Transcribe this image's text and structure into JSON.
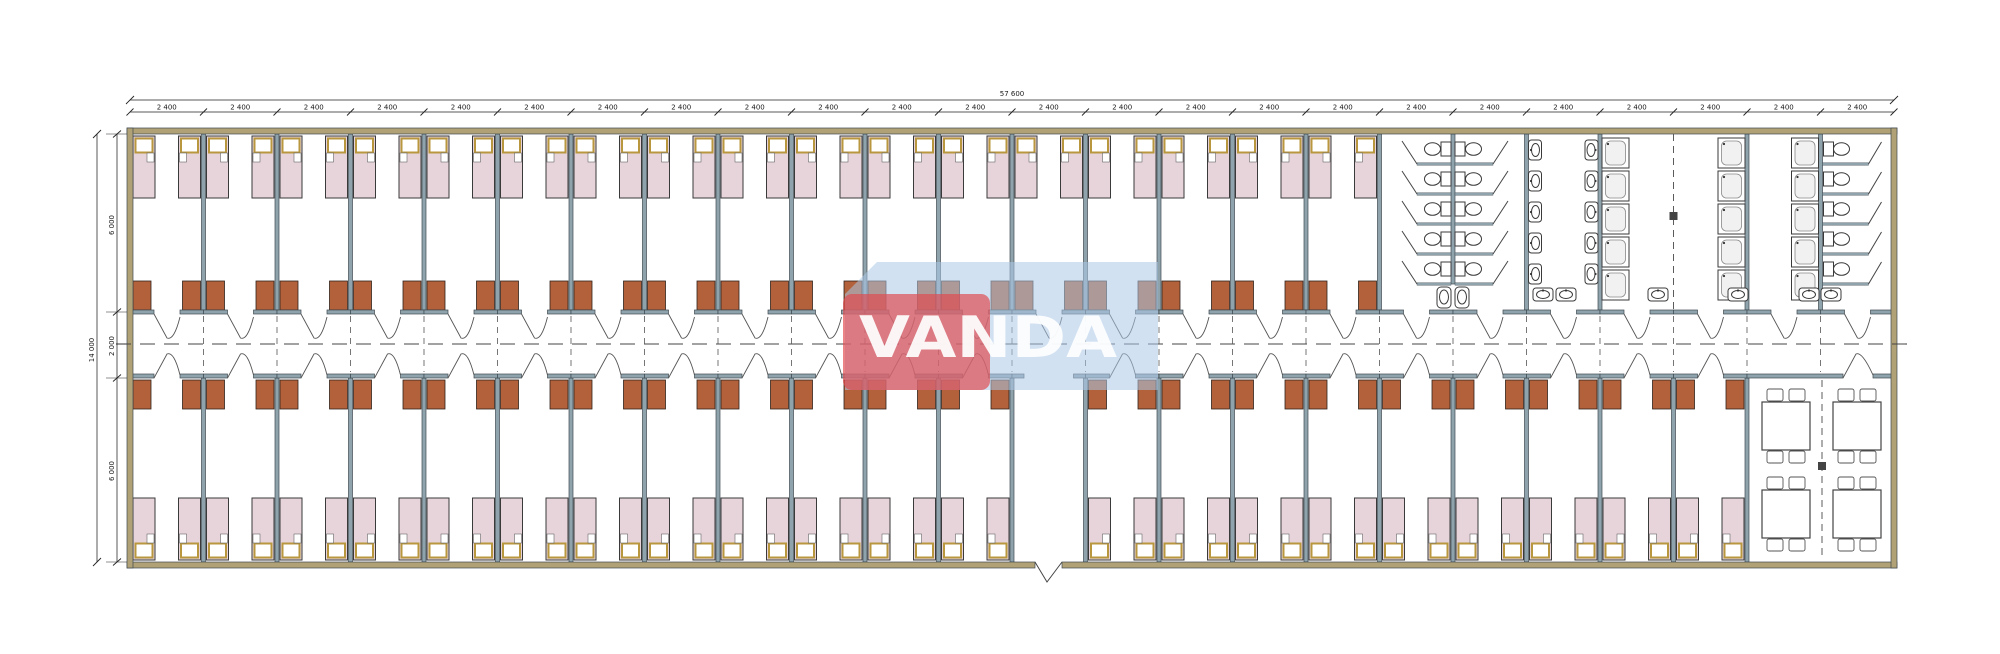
{
  "drawing": {
    "type": "architectural floor plan - dormitory module building",
    "watermark": {
      "text": "VANDA",
      "red_color": "#e04a4e",
      "blue_color": "#abc9e8",
      "text_color": "#ffffff"
    },
    "dimensions": {
      "total_width_label": "57 600",
      "module_width_label": "2 400",
      "module_count": 24,
      "height_total_label": "14 000",
      "height_segment_labels": [
        "6 000",
        "2 000",
        "6 000"
      ]
    },
    "layout": {
      "top_bedroom_count": 17,
      "bottom_bedroom_count": 21,
      "beds_per_room": 2,
      "wardrobes_per_room": 2,
      "entrance_vestibule_module_index": 12,
      "sanitary": {
        "wc_stall_rows": 5,
        "wc_back_to_back_columns": 2,
        "urinal_pair_count": 2,
        "sink_column_count": 2,
        "sinks_per_column": 5,
        "shower_column_count": 3,
        "showers_per_column": 5,
        "wc_with_door_count": 5,
        "bottom_wall_sink_count": 6
      },
      "dining": {
        "table_count": 4,
        "chairs_per_table": 4
      }
    },
    "colors": {
      "wall_interior": "#8fa3ad",
      "wall_exterior": "#b0a176",
      "wall_outline": "#3f4a50",
      "bed_fill": "#e7d4da",
      "pillow_border": "#b8973f",
      "wardrobe_fill": "#b2613a",
      "fixture_stroke": "#3a3a3a",
      "dash_color": "#4a4a4a",
      "dim_color": "#222222"
    }
  }
}
